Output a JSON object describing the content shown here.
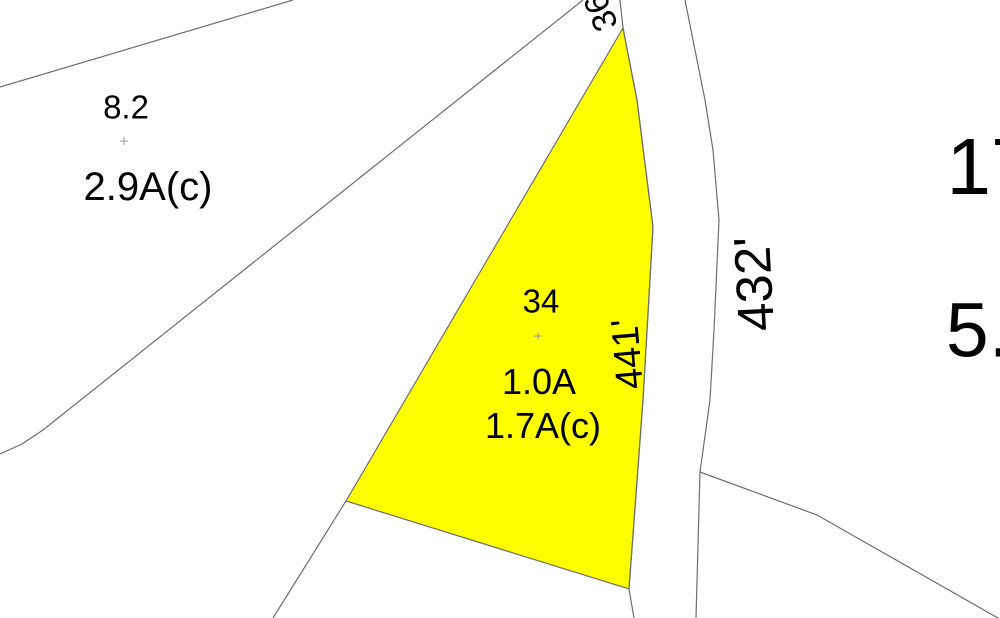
{
  "map": {
    "background_color": "#ffffff",
    "line_color": "#6e6e6e",
    "marker_color": "#9a9a9a",
    "highlight_parcel": {
      "id": "34",
      "fill": "#ffff00",
      "points": [
        [
          623,
          28
        ],
        [
          637,
          100
        ],
        [
          653,
          227
        ],
        [
          643,
          400
        ],
        [
          629,
          589
        ],
        [
          346,
          501
        ]
      ]
    },
    "boundary_lines": [
      {
        "name": "northwest-diagonal",
        "points": [
          [
            0,
            87
          ],
          [
            293,
            0
          ]
        ]
      },
      {
        "name": "long-diagonal",
        "points": [
          [
            583,
            0
          ],
          [
            43,
            430
          ],
          [
            22,
            444
          ],
          [
            0,
            454
          ]
        ]
      },
      {
        "name": "apex-stub",
        "points": [
          [
            620,
            0
          ],
          [
            623,
            28
          ]
        ]
      },
      {
        "name": "road-left-edge",
        "points": [
          [
            623,
            28
          ],
          [
            637,
            100
          ],
          [
            653,
            227
          ],
          [
            643,
            400
          ],
          [
            629,
            589
          ],
          [
            634,
            618
          ]
        ]
      },
      {
        "name": "road-right-edge",
        "points": [
          [
            685,
            0
          ],
          [
            695,
            50
          ],
          [
            705,
            100
          ],
          [
            713,
            150
          ],
          [
            719,
            220
          ],
          [
            714,
            330
          ],
          [
            710,
            400
          ],
          [
            700,
            472
          ],
          [
            696,
            618
          ]
        ]
      },
      {
        "name": "southeast-branch",
        "points": [
          [
            700,
            472
          ],
          [
            817,
            515
          ],
          [
            1005,
            622
          ]
        ]
      },
      {
        "name": "southwest-tail",
        "points": [
          [
            346,
            501
          ],
          [
            273,
            618
          ]
        ]
      }
    ],
    "labels": [
      {
        "id": "parcel-8-2-number",
        "text": "8.2",
        "x": 126,
        "y": 107,
        "size": 33,
        "rotation": 0
      },
      {
        "id": "parcel-8-2-acreage",
        "text": "2.9A(c)",
        "x": 148,
        "y": 187,
        "size": 40,
        "rotation": 0
      },
      {
        "id": "parcel-34-number",
        "text": "34",
        "x": 541,
        "y": 301,
        "size": 33,
        "rotation": 0
      },
      {
        "id": "parcel-34-acreage",
        "text": "1.0A",
        "x": 539,
        "y": 382,
        "size": 36,
        "rotation": 0
      },
      {
        "id": "parcel-34-acreage-c",
        "text": "1.7A(c)",
        "x": 543,
        "y": 426,
        "size": 36,
        "rotation": 0
      },
      {
        "id": "dimension-441ft",
        "text": "441'",
        "x": 628,
        "y": 354,
        "size": 38,
        "rotation": -95
      },
      {
        "id": "dimension-432ft",
        "text": "432'",
        "x": 754,
        "y": 284,
        "size": 51,
        "rotation": -93
      },
      {
        "id": "dimension-36ft",
        "text": "36'",
        "x": 600,
        "y": 9,
        "size": 34,
        "rotation": -112
      },
      {
        "id": "parcel-17-number",
        "text": "17",
        "x": 991,
        "y": 167,
        "size": 80,
        "rotation": 0
      },
      {
        "id": "parcel-5-acreage",
        "text": "5.",
        "x": 978,
        "y": 331,
        "size": 77,
        "rotation": 0
      }
    ],
    "point_markers": [
      {
        "x": 124,
        "y": 141
      },
      {
        "x": 538,
        "y": 336
      }
    ]
  }
}
